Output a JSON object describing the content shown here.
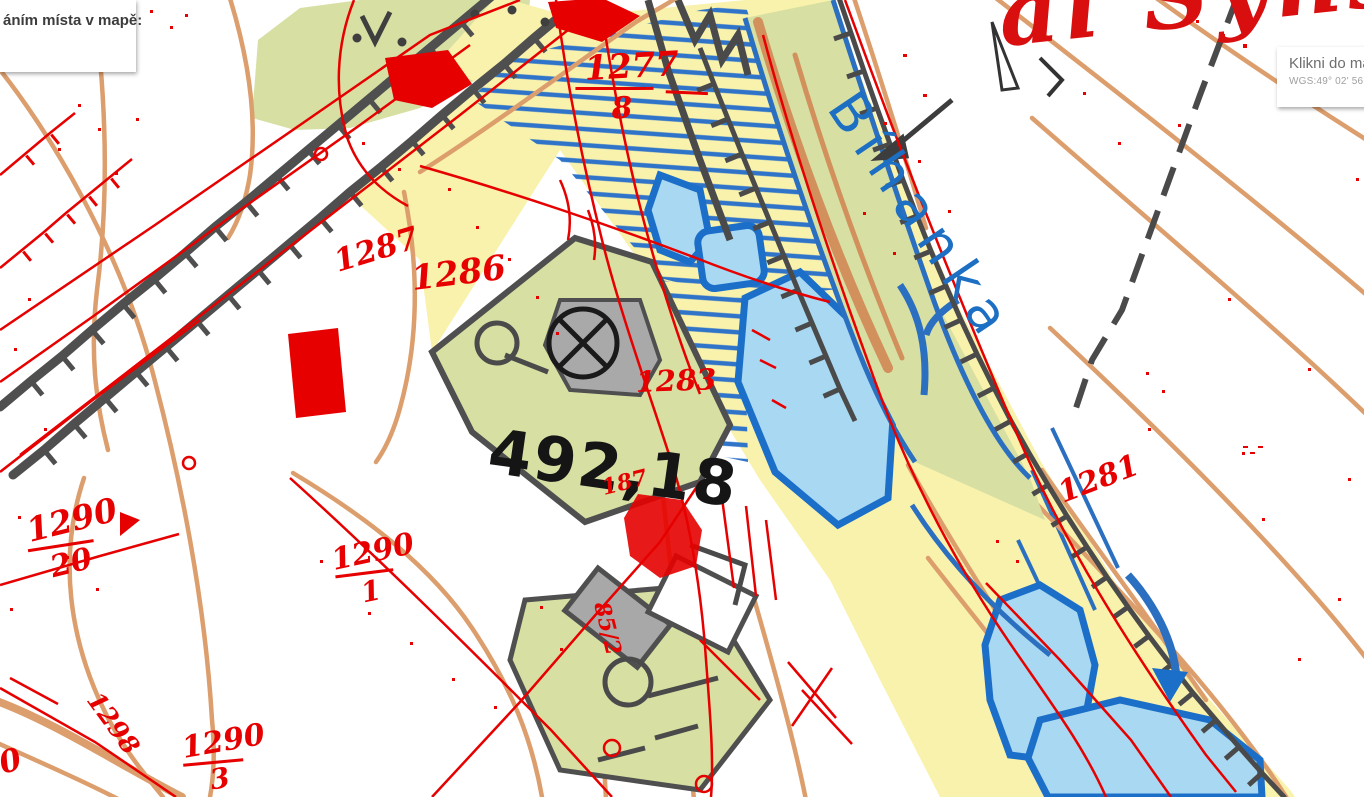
{
  "ui": {
    "left_panel": {
      "text": "áním místa v mapě:"
    },
    "tooltip": {
      "title": "Klikni do map",
      "coords": "WGS:49° 02' 56.6439"
    }
  },
  "map": {
    "stream_label": "Bíhanka",
    "elevation_label": "492,18",
    "script_label": "al Syns",
    "parcels": {
      "p1277": {
        "n": "1277",
        "d": "8"
      },
      "p1290a": {
        "n": "1290",
        "d": "20"
      },
      "p1290b": {
        "n": "1290",
        "d": "1"
      },
      "p1290c": {
        "n": "1290",
        "d": "3"
      },
      "p1287": "1287",
      "p1286": "1286",
      "p1283": "1283",
      "p1281": "1281",
      "p187": "187",
      "p1298": "1298",
      "p85": "85/2",
      "p90": "90"
    },
    "colors": {
      "meadow_yellow": "#F9F2AC",
      "vegetation_green": "#D7DFA3",
      "water_fill": "#A9D8F2",
      "water_stroke": "#1B6FC8",
      "contour_orange": "#DC9E6C",
      "cadastre_red": "#E60000",
      "road_gray": "#4F4F4F",
      "stream_label_blue": "#1C6FC2"
    }
  }
}
